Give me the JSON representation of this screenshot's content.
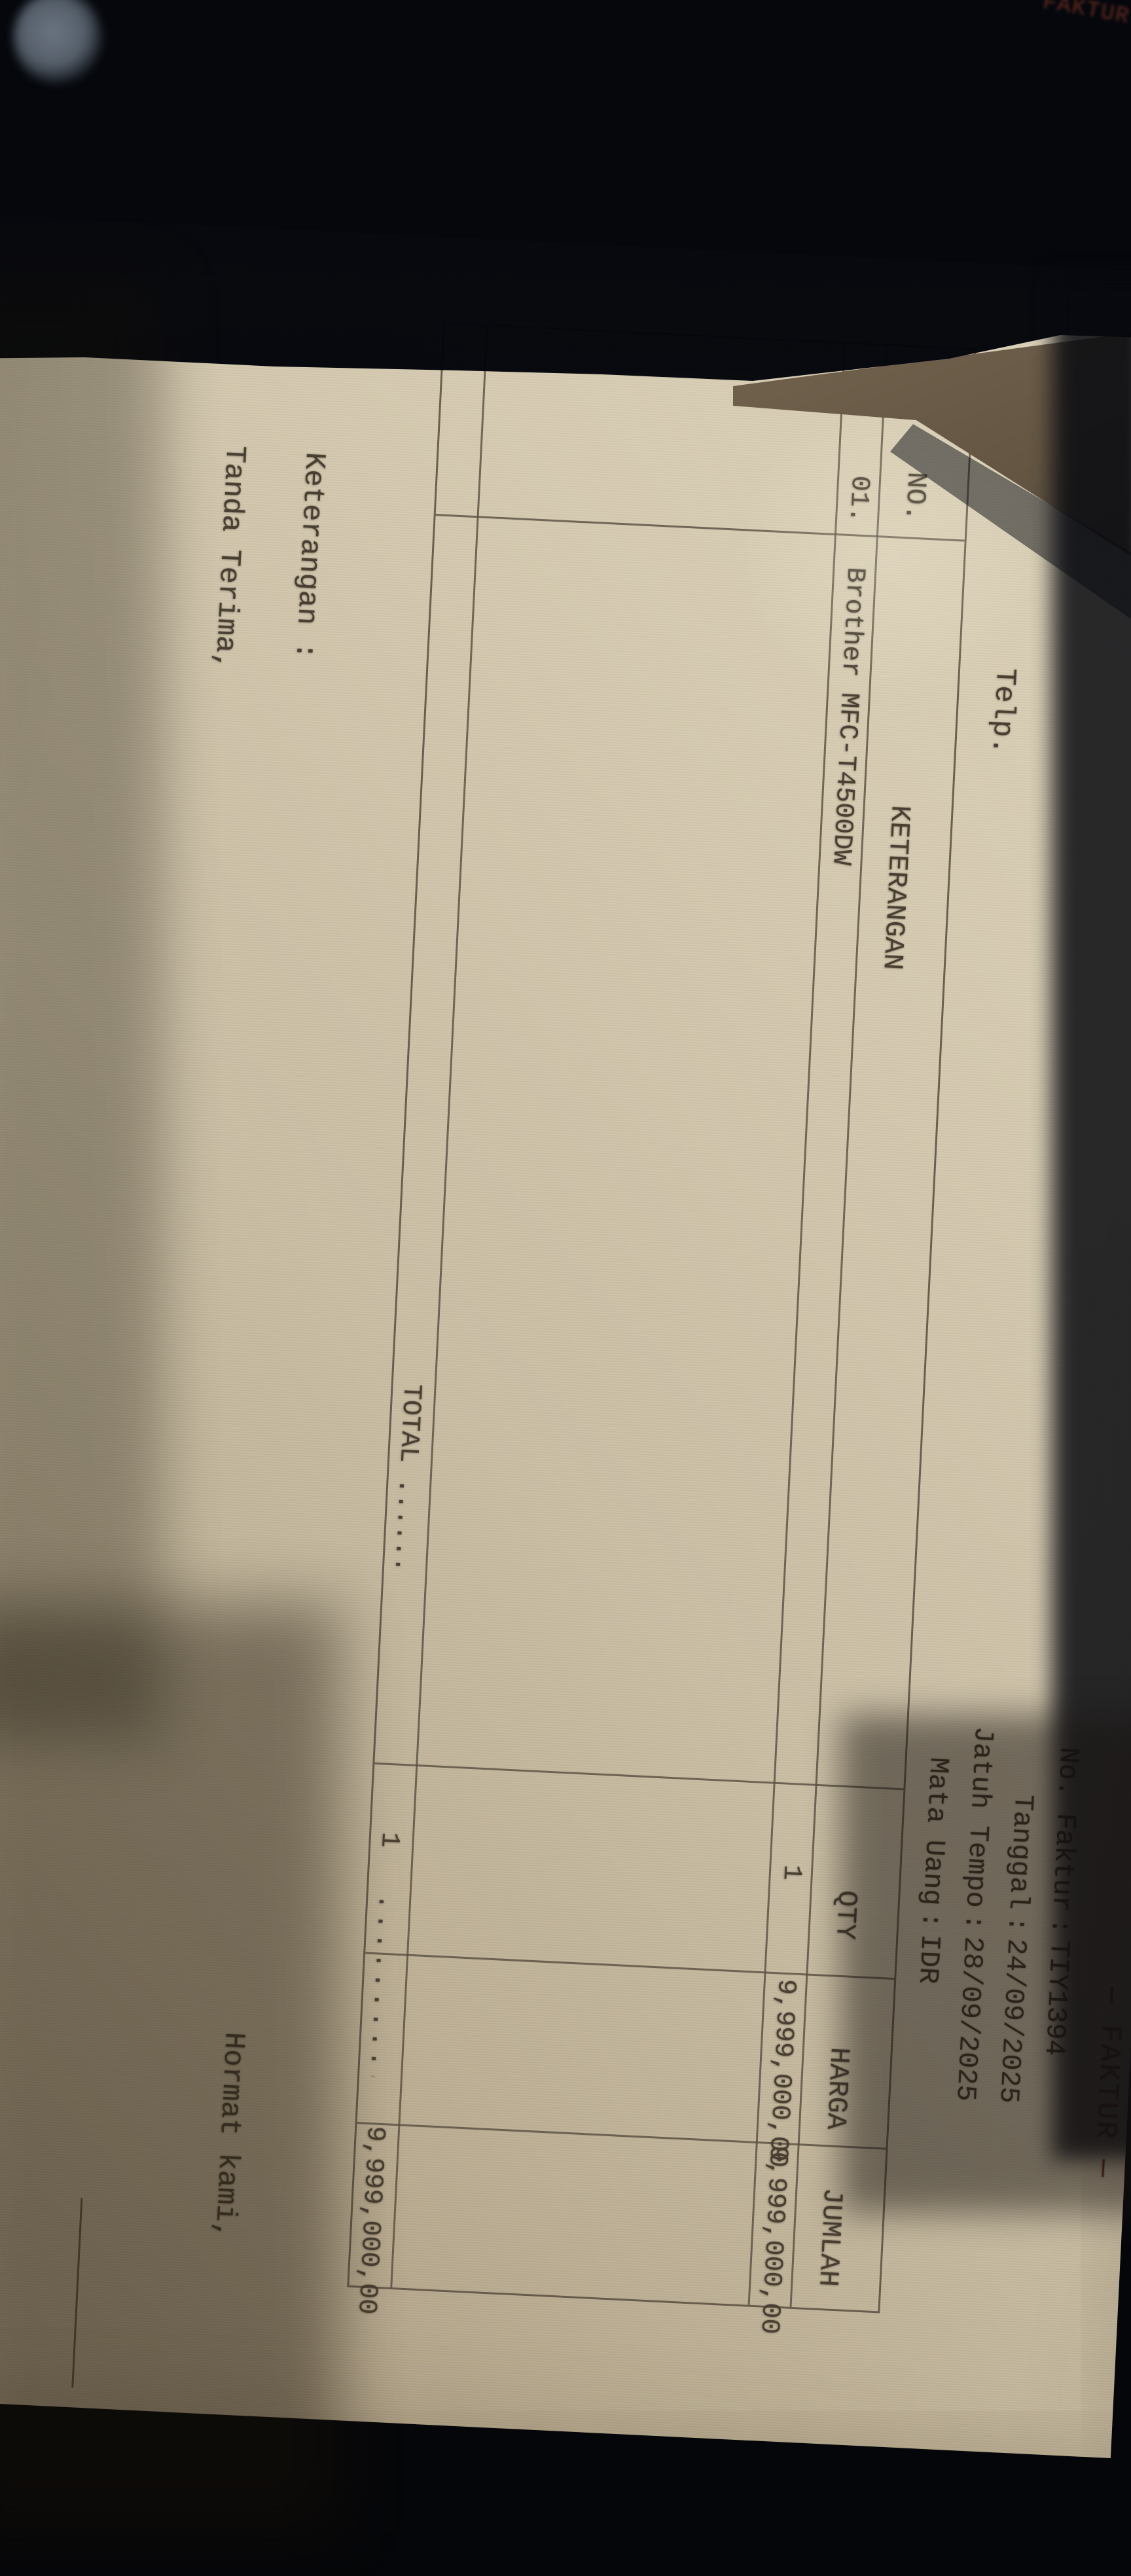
{
  "invoice": {
    "telp_label": "Telp.",
    "title": "— FAKTUR —",
    "sheet2_title": "FAKTUR —",
    "meta": {
      "no_faktur_label": "No. Faktur",
      "no_faktur": "TIY1394",
      "tanggal_label": "Tanggal",
      "tanggal": "24/09/2025",
      "jatuh_tempo_label": "Jatuh Tempo",
      "jatuh_tempo": "28/09/2025",
      "mata_uang_label": "Mata Uang",
      "mata_uang": "IDR",
      "colon": ":"
    },
    "table": {
      "col_no": "NO.",
      "col_keterangan": "KETERANGAN",
      "col_qty": "QTY",
      "col_harga": "HARGA",
      "col_jumlah": "JUMLAH",
      "row1": {
        "no": "01.",
        "keterangan": "Brother MFC-T4500DW",
        "qty": "1",
        "harga": "9,999,000,00",
        "jumlah": "9,999,000,00"
      },
      "total": {
        "label": "TOTAL ......",
        "qty": "1",
        "leader": "............",
        "jumlah": "9,999,000,00"
      }
    },
    "footer": {
      "keterangan": "Keterangan :",
      "tanda_terima": "Tanda Terima,",
      "hormat_kami": "Hormat kami,"
    }
  }
}
